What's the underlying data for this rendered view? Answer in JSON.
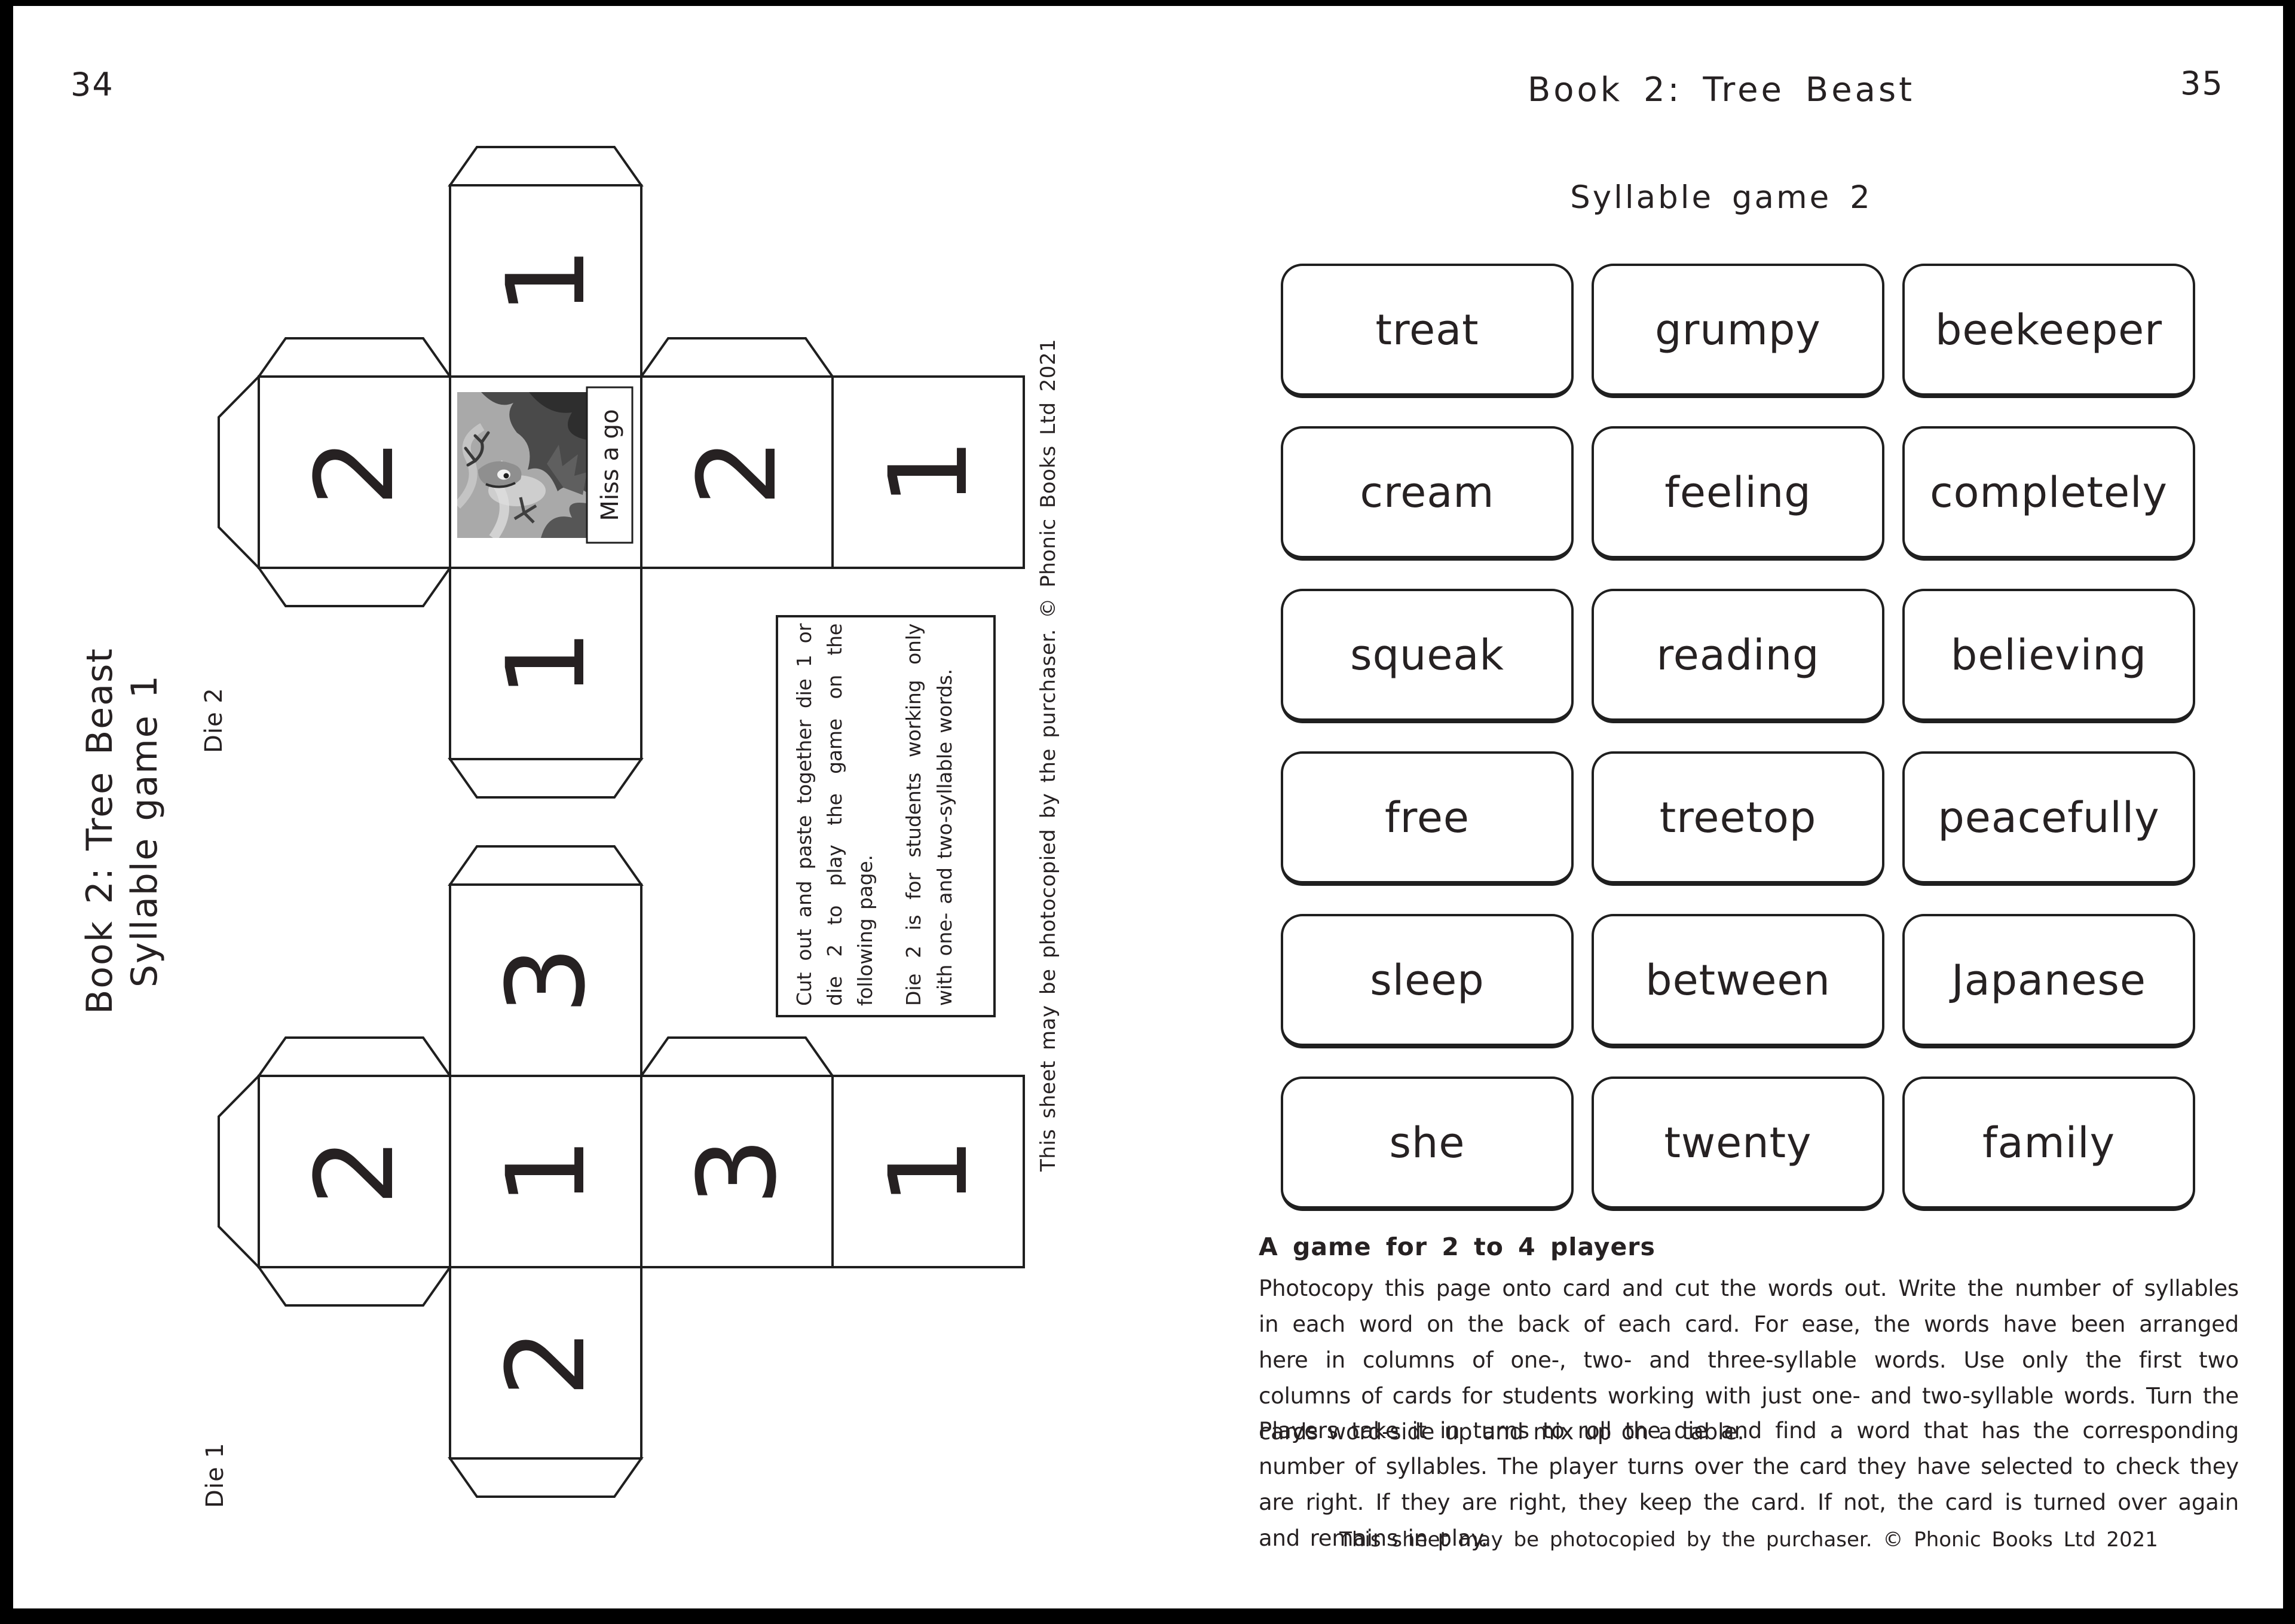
{
  "colors": {
    "ink": "#262122",
    "paper": "#ffffff",
    "line": "#1f1f1f"
  },
  "left_page": {
    "page_number": "34",
    "sidebar_title_line1": "Book 2: Tree Beast",
    "sidebar_title_line2": "Syllable game 1",
    "die2": {
      "label": "Die 2",
      "top": "1",
      "row_left": "2",
      "row_right": "2",
      "row_far_right": "1",
      "bottom": "1",
      "miss_a_go": "Miss a go"
    },
    "die1": {
      "label": "Die 1",
      "top": "3",
      "row_left": "2",
      "row_center": "1",
      "row_right": "3",
      "row_far_right": "1",
      "bottom": "2"
    },
    "instructions_p1": "Cut out and paste together die 1 or die 2 to play the game on the following page.",
    "instructions_p2": "Die 2 is for students working only with one- and two-syllable words.",
    "copyright": "This sheet may be photocopied by the purchaser.  © Phonic Books Ltd 2021"
  },
  "right_page": {
    "page_number": "35",
    "title": "Book 2: Tree Beast",
    "subtitle": "Syllable game 2",
    "cards": [
      [
        "treat",
        "grumpy",
        "beekeeper"
      ],
      [
        "cream",
        "feeling",
        "completely"
      ],
      [
        "squeak",
        "reading",
        "believing"
      ],
      [
        "free",
        "treetop",
        "peacefully"
      ],
      [
        "sleep",
        "between",
        "Japanese"
      ],
      [
        "she",
        "twenty",
        "family"
      ]
    ],
    "players_heading": "A game for 2 to 4 players",
    "paragraph1": "Photocopy this page onto card and cut the words out. Write the number of syllables in each word on the back of each card. For ease, the words have been arranged here in columns of one-, two- and three-syllable words. Use only the first two columns of cards for students working with just one- and two-syllable words. Turn the cards word-side up and mix up on a table.",
    "paragraph2": "Players take it in turns to roll the die and find a word that has the corresponding number of syllables. The player turns over the card they have selected to check they are right. If they are right, they keep the card. If not, the card is turned over again and remains in play.",
    "copyright": "This sheet may be photocopied by the purchaser.  © Phonic Books Ltd 2021"
  }
}
